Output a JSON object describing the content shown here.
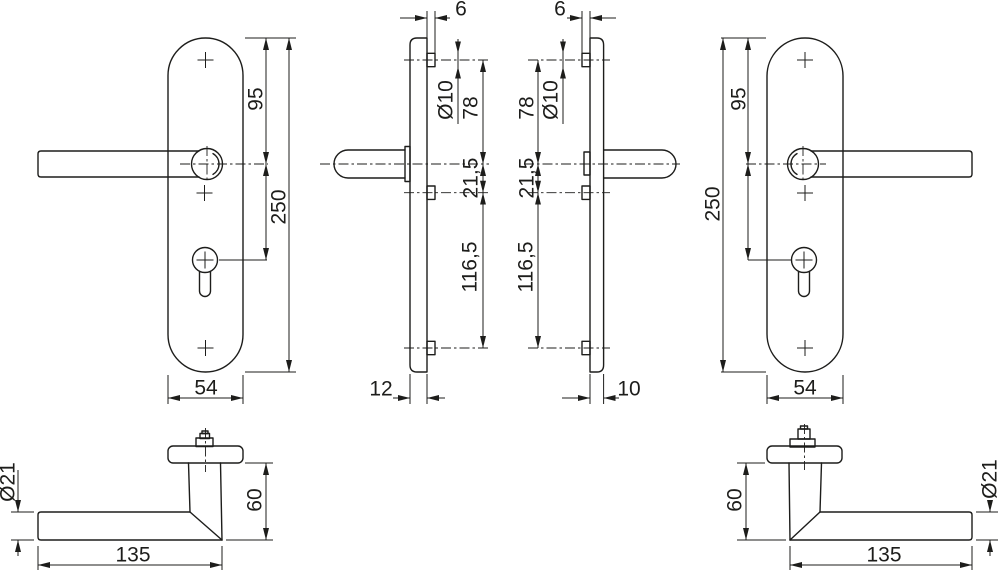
{
  "colors": {
    "ink": "#1d1d1b",
    "background": "#ffffff"
  },
  "views": {
    "front_left": {
      "top_to_handle": "95",
      "plate_height": "250",
      "plate_width": "54"
    },
    "profile_left": {
      "boss_depth": "6",
      "boss_dia": "Ø10",
      "top_screw_to_handle": "78",
      "handle_to_screw": "21,5",
      "screw_spacing": "116,5",
      "plate_depth": "12"
    },
    "profile_right": {
      "boss_depth": "6",
      "boss_dia": "Ø10",
      "top_screw_to_handle": "78",
      "handle_to_screw": "21,5",
      "screw_spacing": "116,5",
      "plate_depth": "10"
    },
    "front_right": {
      "top_to_handle": "95",
      "plate_height": "250",
      "plate_width": "54"
    },
    "lever_left": {
      "grip_dia": "Ø21",
      "neck_height": "60",
      "length": "135"
    },
    "lever_right": {
      "grip_dia": "Ø21",
      "neck_height": "60",
      "length": "135"
    }
  }
}
